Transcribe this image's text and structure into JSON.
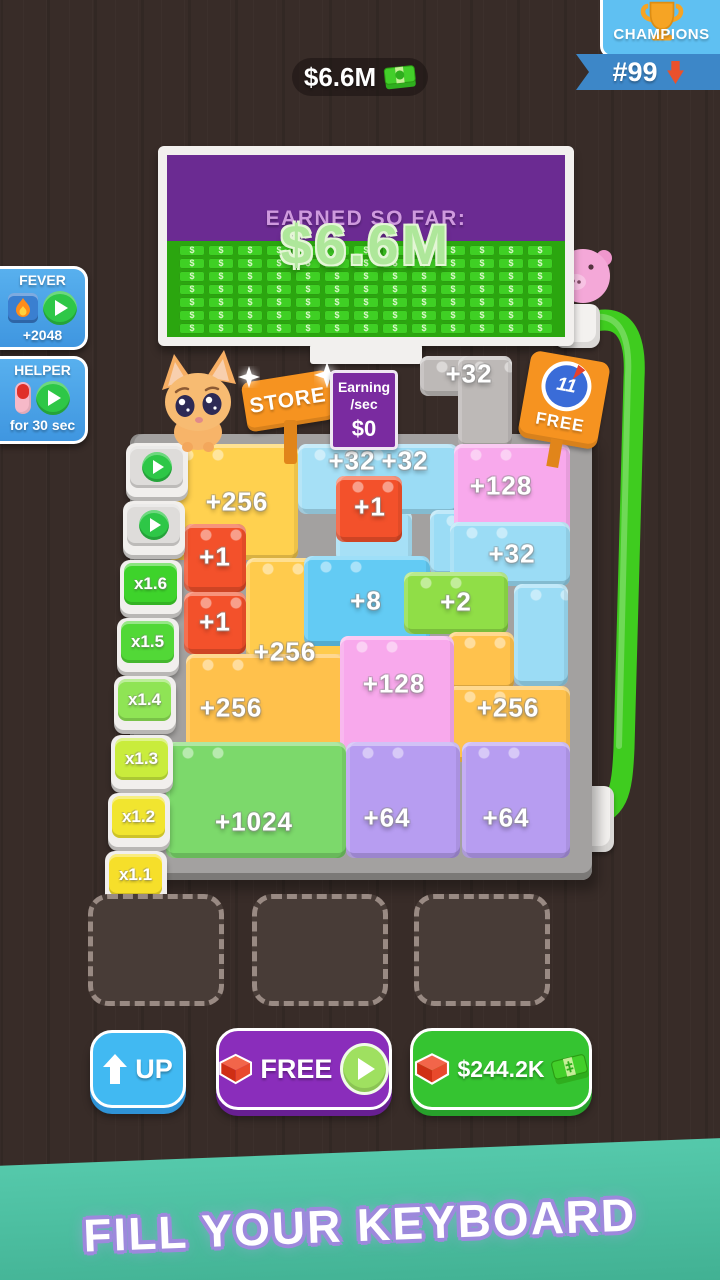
{
  "topbar": {
    "balance": "$6.6M",
    "champions": {
      "title": "CHAMPIONS",
      "rank": "#99"
    }
  },
  "billboard": {
    "heading": "EARNED SO FAR:",
    "amount": "$6.6M",
    "pattern": {
      "rows": 7,
      "cols": 13,
      "symbol": "$"
    }
  },
  "boosters": {
    "fever": {
      "title": "FEVER",
      "reward": "+2048"
    },
    "helper": {
      "title": "HELPER",
      "duration": "for 30 sec"
    }
  },
  "signs": {
    "store": "STORE",
    "earning_line1": "Earning",
    "earning_line2": "/sec",
    "earning_value": "$0",
    "free_count": "11",
    "free_label": "FREE"
  },
  "board": {
    "keys": [
      {
        "type": "play"
      },
      {
        "type": "play"
      },
      {
        "type": "mult",
        "label": "x1.6",
        "color": "#3ed32b"
      },
      {
        "type": "mult",
        "label": "x1.5",
        "color": "#52d837"
      },
      {
        "type": "mult",
        "label": "x1.4",
        "color": "#8fe455"
      },
      {
        "type": "mult",
        "label": "x1.3",
        "color": "#c9ec3c"
      },
      {
        "type": "mult",
        "label": "x1.2",
        "color": "#f1e52f"
      },
      {
        "type": "mult",
        "label": "x1.1",
        "color": "#f6df2a"
      }
    ],
    "pieces": [
      {
        "x": 420,
        "y": 356,
        "w": 92,
        "h": 40,
        "c": "#bdb9b7"
      },
      {
        "x": 458,
        "y": 356,
        "w": 54,
        "h": 92,
        "c": "#bdb9b7"
      },
      {
        "x": 166,
        "y": 444,
        "w": 132,
        "h": 116,
        "c": "#ffd14f"
      },
      {
        "x": 246,
        "y": 558,
        "w": 100,
        "h": 102,
        "c": "#ffcb4d"
      },
      {
        "x": 186,
        "y": 654,
        "w": 160,
        "h": 110,
        "c": "#ffc14c"
      },
      {
        "x": 298,
        "y": 444,
        "w": 114,
        "h": 70,
        "c": "#a6e0f6"
      },
      {
        "x": 336,
        "y": 510,
        "w": 76,
        "h": 56,
        "c": "#a6e0f6"
      },
      {
        "x": 356,
        "y": 444,
        "w": 102,
        "h": 70,
        "c": "#9bdcf5"
      },
      {
        "x": 430,
        "y": 510,
        "w": 72,
        "h": 66,
        "c": "#9bdcf5"
      },
      {
        "x": 454,
        "y": 444,
        "w": 116,
        "h": 108,
        "c": "#f8a9ec"
      },
      {
        "x": 450,
        "y": 522,
        "w": 120,
        "h": 64,
        "c": "#9bdcf5"
      },
      {
        "x": 514,
        "y": 584,
        "w": 54,
        "h": 102,
        "c": "#9bdcf5"
      },
      {
        "x": 336,
        "y": 476,
        "w": 66,
        "h": 66,
        "c": "#f3512b"
      },
      {
        "x": 304,
        "y": 556,
        "w": 126,
        "h": 90,
        "c": "#63cbf4"
      },
      {
        "x": 404,
        "y": 572,
        "w": 104,
        "h": 62,
        "c": "#90de47"
      },
      {
        "x": 184,
        "y": 524,
        "w": 62,
        "h": 68,
        "c": "#f3512b"
      },
      {
        "x": 184,
        "y": 592,
        "w": 62,
        "h": 62,
        "c": "#f3512b"
      },
      {
        "x": 448,
        "y": 632,
        "w": 66,
        "h": 58,
        "c": "#ffc24d"
      },
      {
        "x": 448,
        "y": 686,
        "w": 122,
        "h": 76,
        "c": "#ffc24d"
      },
      {
        "x": 340,
        "y": 636,
        "w": 114,
        "h": 124,
        "c": "#f8a9ec"
      },
      {
        "x": 166,
        "y": 742,
        "w": 180,
        "h": 116,
        "c": "#7cd96b"
      },
      {
        "x": 346,
        "y": 742,
        "w": 114,
        "h": 116,
        "c": "#b79df1"
      },
      {
        "x": 462,
        "y": 742,
        "w": 108,
        "h": 116,
        "c": "#b79df1"
      }
    ],
    "labels": [
      {
        "text": "+32",
        "x": 469,
        "y": 374
      },
      {
        "text": "+32",
        "x": 352,
        "y": 461
      },
      {
        "text": "+32",
        "x": 405,
        "y": 461
      },
      {
        "text": "+128",
        "x": 501,
        "y": 486
      },
      {
        "text": "+256",
        "x": 237,
        "y": 502
      },
      {
        "text": "+1",
        "x": 370,
        "y": 507
      },
      {
        "text": "+32",
        "x": 512,
        "y": 554
      },
      {
        "text": "+1",
        "x": 215,
        "y": 557
      },
      {
        "text": "+8",
        "x": 366,
        "y": 601
      },
      {
        "text": "+2",
        "x": 456,
        "y": 602
      },
      {
        "text": "+1",
        "x": 215,
        "y": 622
      },
      {
        "text": "+256",
        "x": 285,
        "y": 652
      },
      {
        "text": "+128",
        "x": 394,
        "y": 684
      },
      {
        "text": "+256",
        "x": 231,
        "y": 708
      },
      {
        "text": "+256",
        "x": 508,
        "y": 708
      },
      {
        "text": "+1024",
        "x": 254,
        "y": 822
      },
      {
        "text": "+64",
        "x": 387,
        "y": 818
      },
      {
        "text": "+64",
        "x": 506,
        "y": 818
      }
    ]
  },
  "footer": {
    "up_label": "UP",
    "free_label": "FREE",
    "buy_label": "$244.2K"
  },
  "banner": {
    "text": "FILL YOUR KEYBOARD"
  }
}
